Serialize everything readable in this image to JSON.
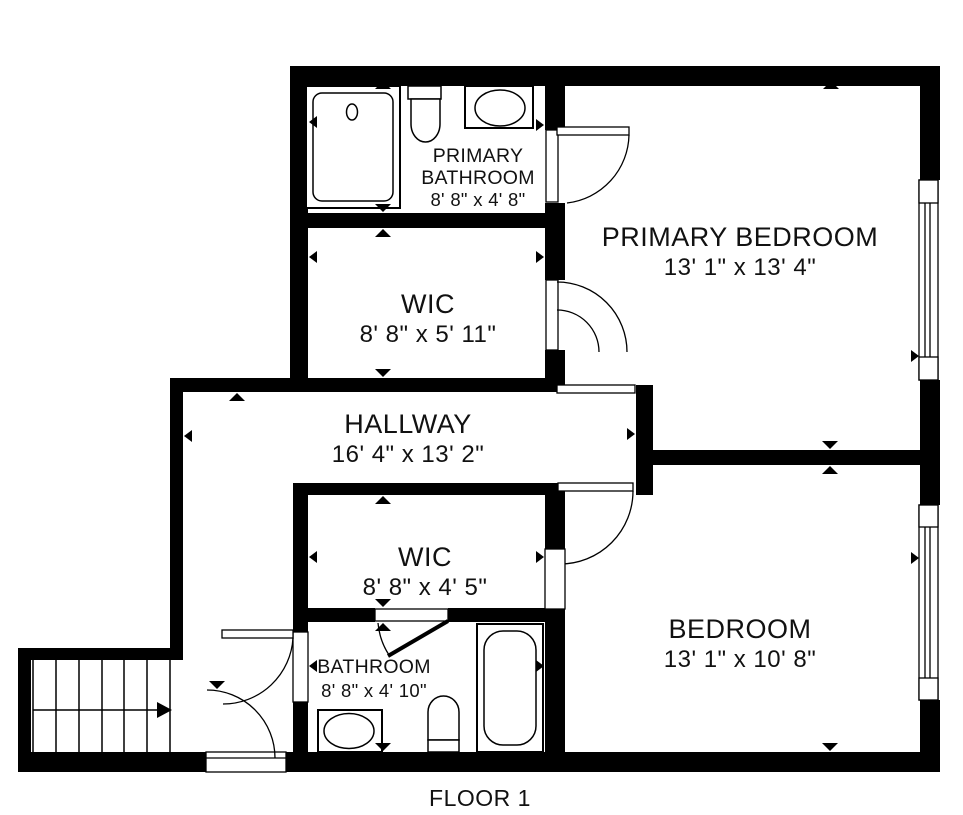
{
  "title": "FLOOR 1",
  "rooms": {
    "primary_bathroom": {
      "name_line1": "PRIMARY",
      "name_line2": "BATHROOM",
      "dims": "8' 8\" x 4' 8\""
    },
    "primary_bedroom": {
      "name": "PRIMARY BEDROOM",
      "dims": "13' 1\" x 13' 4\""
    },
    "wic_upper": {
      "name": "WIC",
      "dims": "8' 8\" x 5' 11\""
    },
    "hallway": {
      "name": "HALLWAY",
      "dims": "16' 4\" x 13' 2\""
    },
    "wic_lower": {
      "name": "WIC",
      "dims": "8' 8\" x 4' 5\""
    },
    "bathroom": {
      "name": "BATHROOM",
      "dims": "8' 8\" x 4' 10\""
    },
    "bedroom": {
      "name": "BEDROOM",
      "dims": "13' 1\" x 10' 8\""
    }
  },
  "colors": {
    "wall": "#000000",
    "background": "#ffffff",
    "text": "#111111"
  }
}
